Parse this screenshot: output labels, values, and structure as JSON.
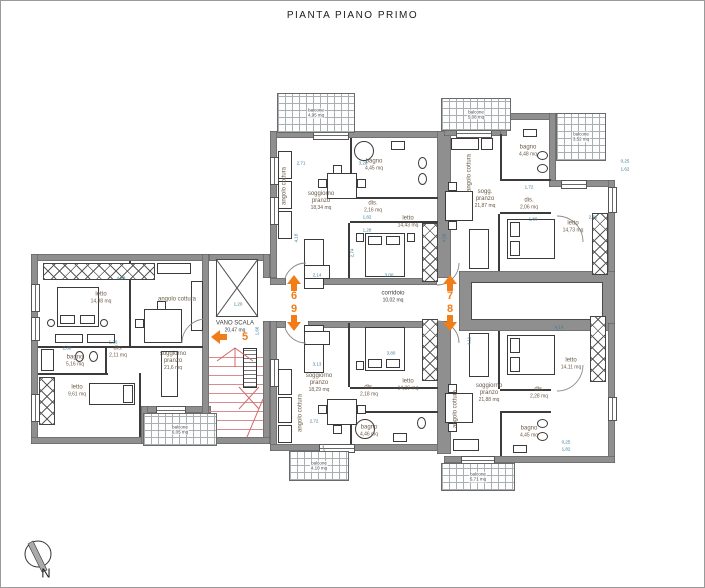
{
  "title": "PIANTA PIANO PRIMO",
  "compass": {
    "label": "N"
  },
  "colors": {
    "wall": "#8f8f8f",
    "dimension": "#3a7d99",
    "room_label": "#6b5a48",
    "accent_orange": "#f07d18",
    "stairs_red": "#d78d8d"
  },
  "rooms": [
    {
      "label": "soggiorno\npranzo",
      "area": "18,34 mq",
      "x": 320,
      "y": 200
    },
    {
      "label": "bagno",
      "area": "4,45 mq",
      "x": 373,
      "y": 164
    },
    {
      "label": "dis.",
      "area": "2,16 mq",
      "x": 372,
      "y": 206
    },
    {
      "label": "letto",
      "area": "14,43 mq",
      "x": 407,
      "y": 221
    },
    {
      "label": "angolo cottura",
      "x": 284,
      "y": 185,
      "vertical": true
    },
    {
      "label": "sogg.\npranzo",
      "area": "21,87 mq",
      "x": 484,
      "y": 198
    },
    {
      "label": "bagno",
      "area": "4,48 mq",
      "x": 527,
      "y": 150
    },
    {
      "label": "dis.",
      "area": "2,06 mq",
      "x": 528,
      "y": 203
    },
    {
      "label": "letto",
      "area": "14,73 mq",
      "x": 572,
      "y": 226
    },
    {
      "label": "angolo cottura",
      "x": 469,
      "y": 172,
      "vertical": true
    },
    {
      "label": "soggiorno\npranzo",
      "area": "18,29 mq",
      "x": 318,
      "y": 382
    },
    {
      "label": "dis.",
      "area": "2,18 mq",
      "x": 368,
      "y": 390
    },
    {
      "label": "letto",
      "area": "14,29 mq",
      "x": 407,
      "y": 384
    },
    {
      "label": "bagno",
      "area": "4,46 mq",
      "x": 368,
      "y": 430
    },
    {
      "label": "angolo cottura",
      "x": 300,
      "y": 412,
      "vertical": true
    },
    {
      "label": "soggiorno\npranzo",
      "area": "21,88 mq",
      "x": 488,
      "y": 392
    },
    {
      "label": "dis.",
      "area": "2,28 mq",
      "x": 538,
      "y": 392
    },
    {
      "label": "letto",
      "area": "14,11 mq",
      "x": 570,
      "y": 363
    },
    {
      "label": "bagno",
      "area": "4,45 mq",
      "x": 528,
      "y": 431
    },
    {
      "label": "angolo cottura",
      "x": 455,
      "y": 408,
      "vertical": true
    },
    {
      "label": "letto",
      "area": "14,38 mq",
      "x": 100,
      "y": 297
    },
    {
      "label": "angolo cottura",
      "x": 176,
      "y": 299
    },
    {
      "label": "dis.",
      "area": "2,11 mq",
      "x": 117,
      "y": 351
    },
    {
      "label": "bagno",
      "area": "5,16 mq",
      "x": 74,
      "y": 360
    },
    {
      "label": "letto",
      "area": "9,61 mq",
      "x": 76,
      "y": 390
    },
    {
      "label": "soggiorno\npranzo",
      "area": "21,6 mq",
      "x": 172,
      "y": 360
    },
    {
      "label": "VANO SCALA",
      "area": "20,47 mq",
      "x": 234,
      "y": 326,
      "cls": "plain"
    },
    {
      "label": "corridoio",
      "area": "10,02 mq",
      "x": 392,
      "y": 296,
      "cls": "plain"
    }
  ],
  "balconies": [
    {
      "label": "balcone",
      "area": "4,95 mq",
      "x": 276,
      "y": 92,
      "w": 76,
      "h": 38
    },
    {
      "label": "balcone",
      "area": "5,08 mq",
      "x": 440,
      "y": 97,
      "w": 68,
      "h": 31
    },
    {
      "label": "balcone",
      "area": "3,52 mq",
      "x": 555,
      "y": 112,
      "w": 48,
      "h": 46
    },
    {
      "label": "balcone",
      "area": "6,05 mq",
      "x": 142,
      "y": 412,
      "w": 72,
      "h": 31
    },
    {
      "label": "balcone",
      "area": "4,10 mq",
      "x": 288,
      "y": 450,
      "w": 58,
      "h": 28
    },
    {
      "label": "balcone",
      "area": "5,71 mq",
      "x": 440,
      "y": 462,
      "w": 72,
      "h": 26
    }
  ],
  "entrances": [
    {
      "number": "5",
      "x": 244,
      "y": 336,
      "dir": "left",
      "ax": 210,
      "ay": 329
    },
    {
      "number": "6",
      "x": 293,
      "y": 295,
      "dir": "up",
      "ax": 286,
      "ay": 274
    },
    {
      "number": "9",
      "x": 293,
      "y": 308,
      "dir": "down",
      "ax": 286,
      "ay": 314
    },
    {
      "number": "7",
      "x": 449,
      "y": 295,
      "dir": "up",
      "ax": 442,
      "ay": 274
    },
    {
      "number": "8",
      "x": 449,
      "y": 308,
      "dir": "down",
      "ax": 442,
      "ay": 314
    }
  ],
  "dimensions": [
    {
      "t": "2,71",
      "x": 300,
      "y": 162
    },
    {
      "t": "3,28",
      "x": 362,
      "y": 162
    },
    {
      "t": "1,82",
      "x": 366,
      "y": 216
    },
    {
      "t": "1,28",
      "x": 366,
      "y": 229
    },
    {
      "t": "4,18",
      "x": 295,
      "y": 237,
      "v": true
    },
    {
      "t": "2,74",
      "x": 351,
      "y": 252,
      "v": true
    },
    {
      "t": "3,00",
      "x": 388,
      "y": 274
    },
    {
      "t": "2,14",
      "x": 316,
      "y": 274
    },
    {
      "t": "4,58",
      "x": 443,
      "y": 237,
      "v": true
    },
    {
      "t": "1,20",
      "x": 237,
      "y": 303
    },
    {
      "t": "1,66",
      "x": 256,
      "y": 330,
      "v": true
    },
    {
      "t": "4,14",
      "x": 558,
      "y": 326
    },
    {
      "t": "2,31",
      "x": 592,
      "y": 216
    },
    {
      "t": "1,80",
      "x": 532,
      "y": 218
    },
    {
      "t": "1,72",
      "x": 528,
      "y": 186
    },
    {
      "t": "2,88",
      "x": 66,
      "y": 347
    },
    {
      "t": "1,26",
      "x": 112,
      "y": 341
    },
    {
      "t": "4,28",
      "x": 120,
      "y": 277
    },
    {
      "t": "3,13",
      "x": 316,
      "y": 363
    },
    {
      "t": "3,80",
      "x": 390,
      "y": 352
    },
    {
      "t": "2,72",
      "x": 313,
      "y": 420
    },
    {
      "t": "4,11",
      "x": 468,
      "y": 340,
      "v": true
    },
    {
      "t": "0,25",
      "x": 624,
      "y": 160
    },
    {
      "t": "1,62",
      "x": 624,
      "y": 168
    },
    {
      "t": "0,25",
      "x": 565,
      "y": 441
    },
    {
      "t": "1,82",
      "x": 565,
      "y": 448
    }
  ]
}
